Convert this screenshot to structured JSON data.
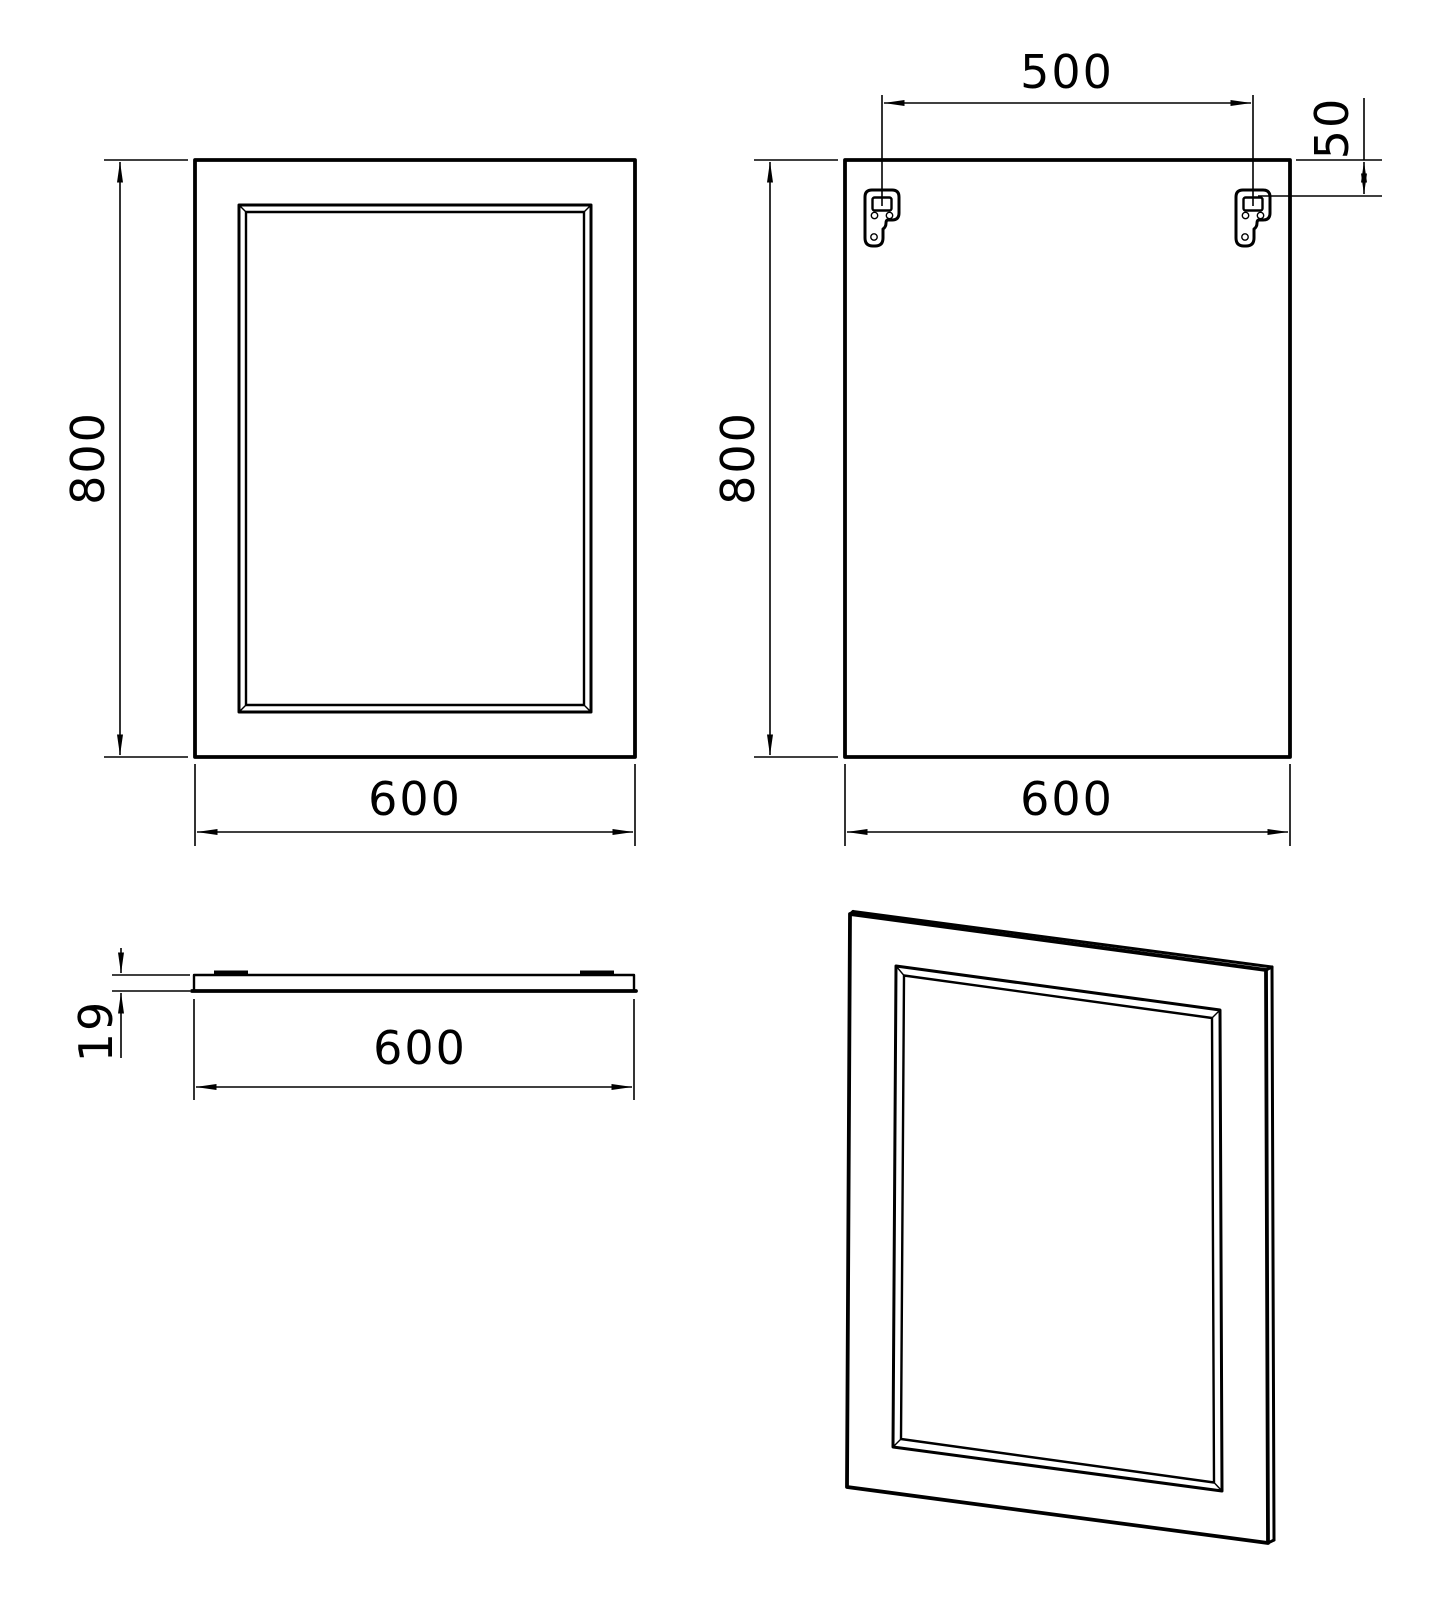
{
  "meta": {
    "background_color": "#ffffff",
    "line_color": "#000000",
    "drawing_type": "technical-orthographic-views-of-framed-mirror-panel"
  },
  "views": {
    "front": {
      "name": "front view",
      "dim_height": "800",
      "dim_width": "600"
    },
    "back": {
      "name": "back view",
      "dim_height": "800",
      "dim_width": "600",
      "dim_bracket_spacing": "500",
      "dim_bracket_top_offset": "50"
    },
    "top_profile": {
      "name": "top profile view",
      "dim_thickness": "19",
      "dim_width": "600"
    },
    "perspective": {
      "name": "perspective view"
    }
  }
}
